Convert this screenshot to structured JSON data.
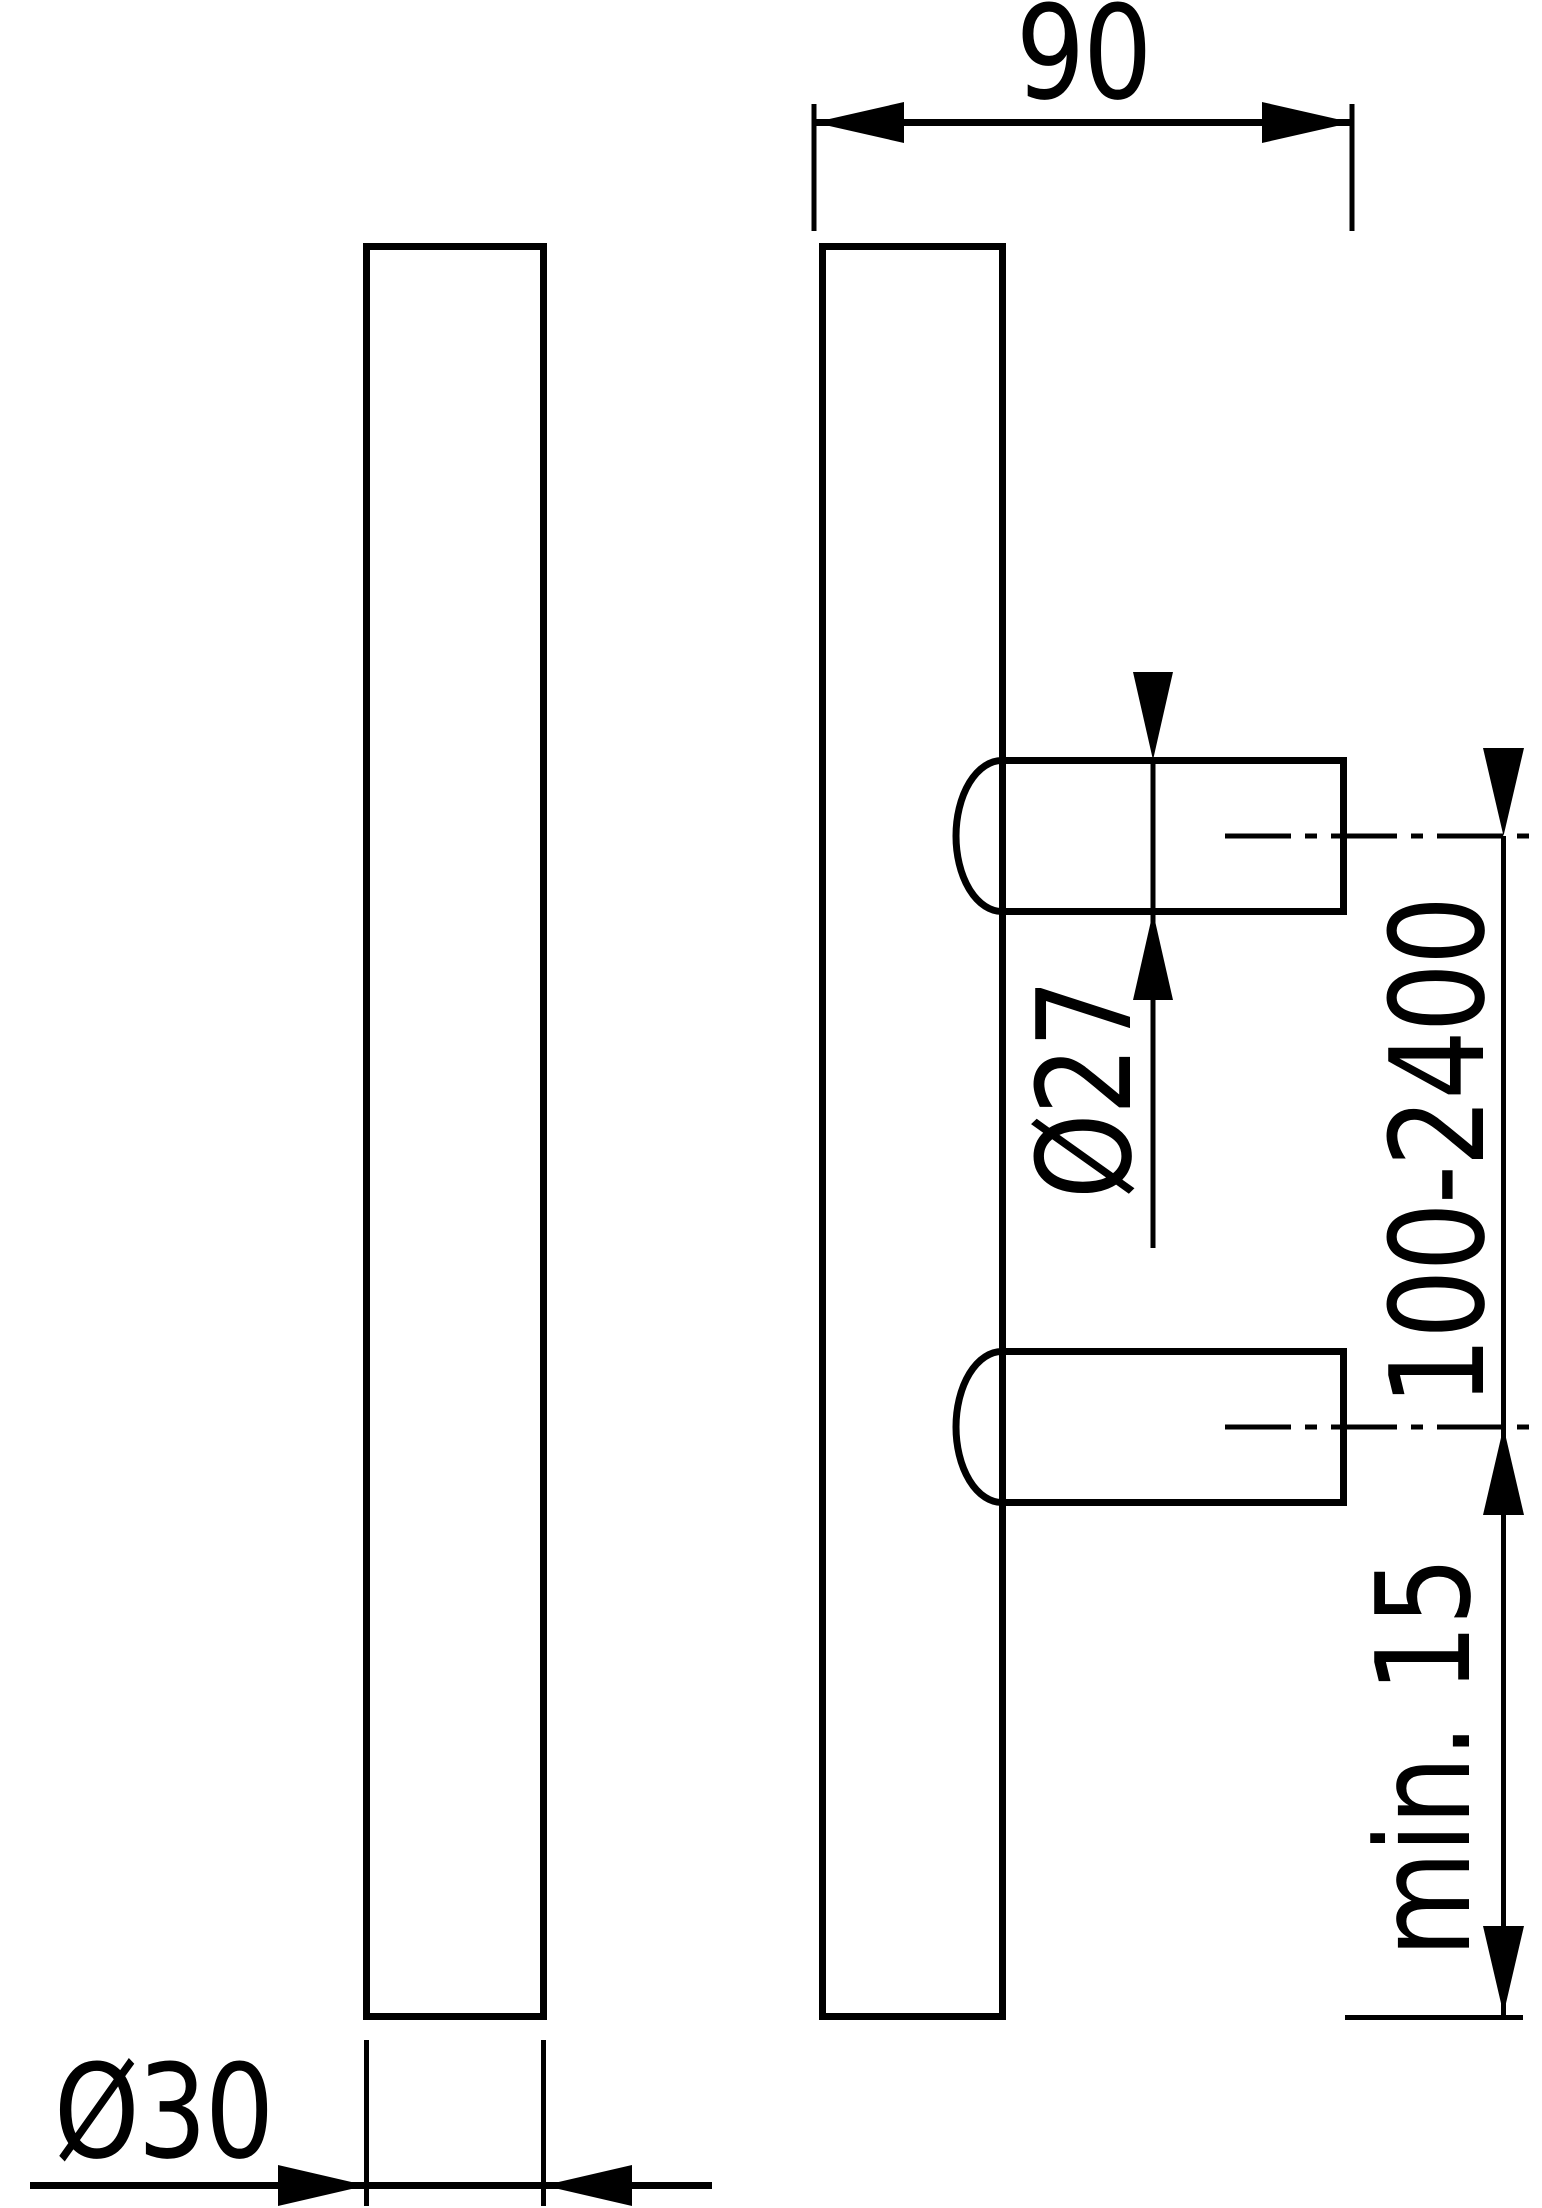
{
  "colors": {
    "background": "#ffffff",
    "line": "#000000"
  },
  "drawing": {
    "labels": {
      "projection_width": "90",
      "post_diameter": "Ø27",
      "mounting_distance": "100-2400",
      "min_depth": "min. 15",
      "bar_diameter": "Ø30"
    }
  }
}
